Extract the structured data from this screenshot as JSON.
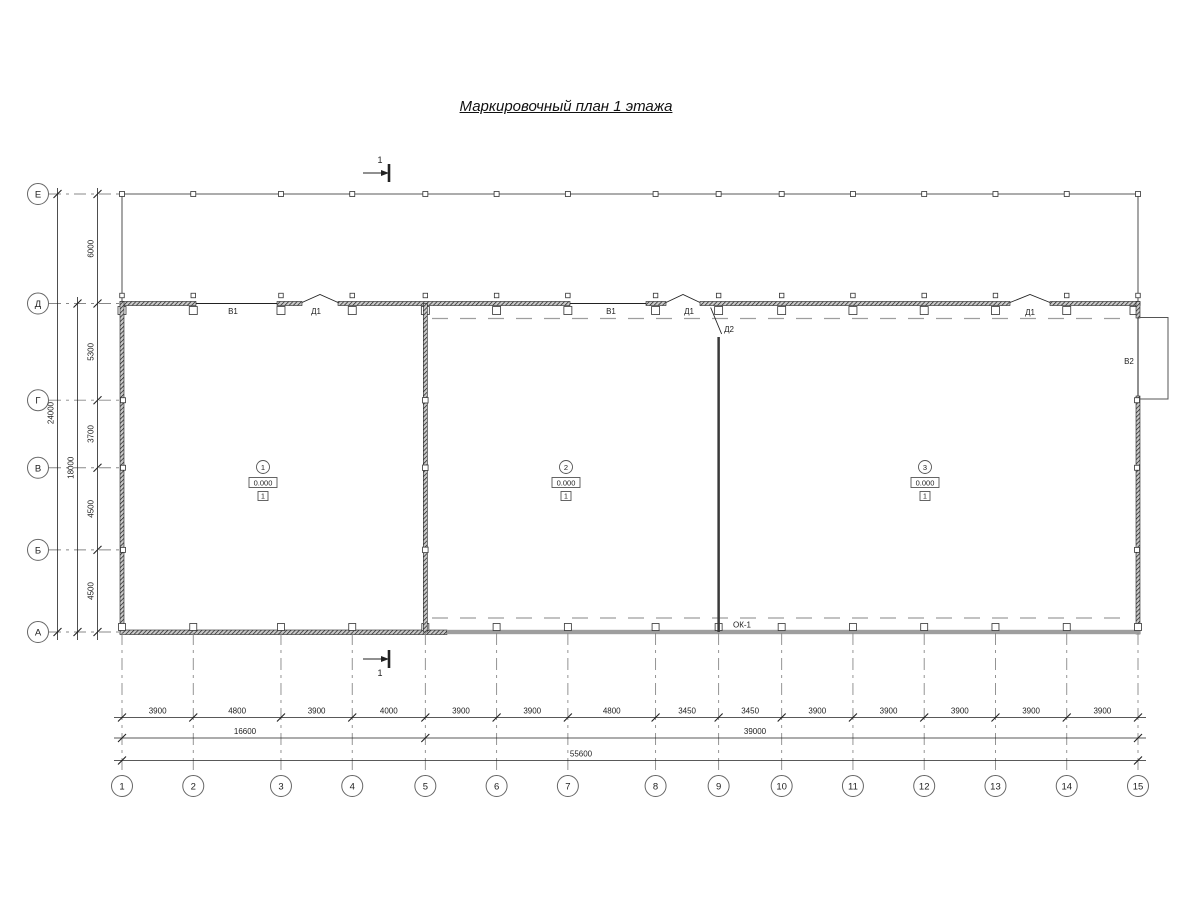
{
  "title": "Маркировочный план 1 этажа",
  "axes": {
    "columns": {
      "labels": [
        "1",
        "2",
        "3",
        "4",
        "5",
        "6",
        "7",
        "8",
        "9",
        "10",
        "11",
        "12",
        "13",
        "14",
        "15"
      ],
      "spacings_mm": [
        3900,
        4800,
        3900,
        4000,
        3900,
        3900,
        4800,
        3450,
        3450,
        3900,
        3900,
        3900,
        3900,
        3900
      ],
      "segment_dims": [
        "3900",
        "4800",
        "3900",
        "4000",
        "3900",
        "3900",
        "4800",
        "3450",
        "3450",
        "3900",
        "3900",
        "3900",
        "3900",
        "3900"
      ],
      "group_dims": [
        {
          "label": "16600",
          "from": 0,
          "to": 4
        },
        {
          "label": "39000",
          "from": 4,
          "to": 14
        }
      ],
      "overall": "55600"
    },
    "rows": {
      "labels": [
        "Е",
        "Д",
        "Г",
        "В",
        "Б",
        "А"
      ],
      "spacings_mm": [
        6000,
        5300,
        3700,
        4500,
        4500
      ],
      "segment_dims": [
        "6000",
        "5300",
        "3700",
        "4500",
        "4500"
      ],
      "group_dims": [
        {
          "label": "18000",
          "from": 1,
          "to": 5
        }
      ],
      "overall": "24000"
    }
  },
  "rooms": [
    {
      "number": "1",
      "elevation": "0.000",
      "floor_type": "1"
    },
    {
      "number": "2",
      "elevation": "0.000",
      "floor_type": "1"
    },
    {
      "number": "3",
      "elevation": "0.000",
      "floor_type": "1"
    }
  ],
  "openings": [
    {
      "mark": "В1"
    },
    {
      "mark": "Д1"
    },
    {
      "mark": "В1"
    },
    {
      "mark": "Д1"
    },
    {
      "mark": "Д2"
    },
    {
      "mark": "Д1"
    },
    {
      "mark": "В2"
    },
    {
      "mark": "ОК-1"
    }
  ],
  "section_marks": [
    {
      "label": "1"
    },
    {
      "label": "1"
    }
  ],
  "colors": {
    "line": "#222222",
    "wall_hatch": "#1a1a1a",
    "grey_wall": "#9e9e9e",
    "dashed_line": "#9e9e9e",
    "grid_line": "#888888"
  }
}
